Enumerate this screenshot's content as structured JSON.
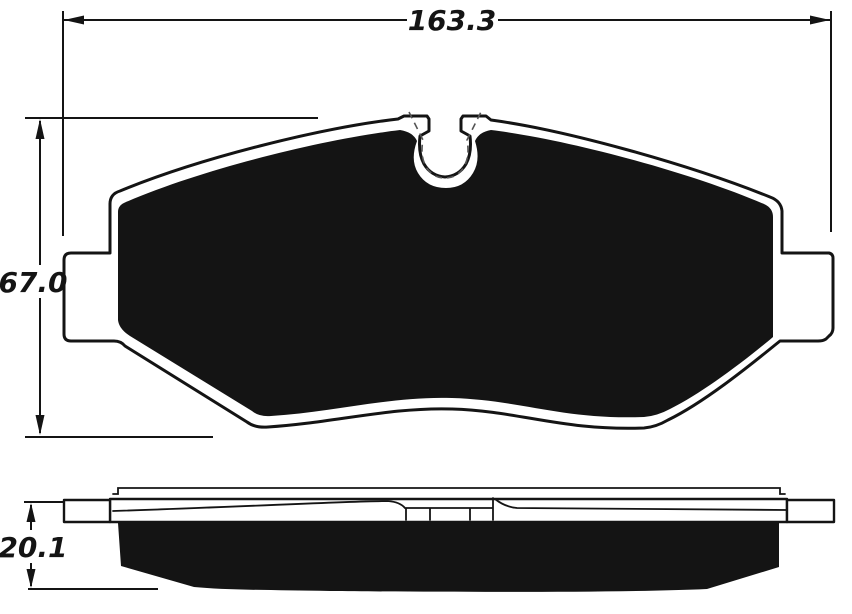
{
  "page": {
    "background": "#ffffff",
    "ink": "#141414",
    "dash_color": "#555555"
  },
  "front_view": {
    "name": "brake-pad-front-view",
    "width_dimension": {
      "value": "163.3"
    },
    "height_dimension": {
      "value": "67.0"
    }
  },
  "side_view": {
    "name": "brake-pad-side-view",
    "thickness_dimension": {
      "value": "20.1"
    }
  }
}
